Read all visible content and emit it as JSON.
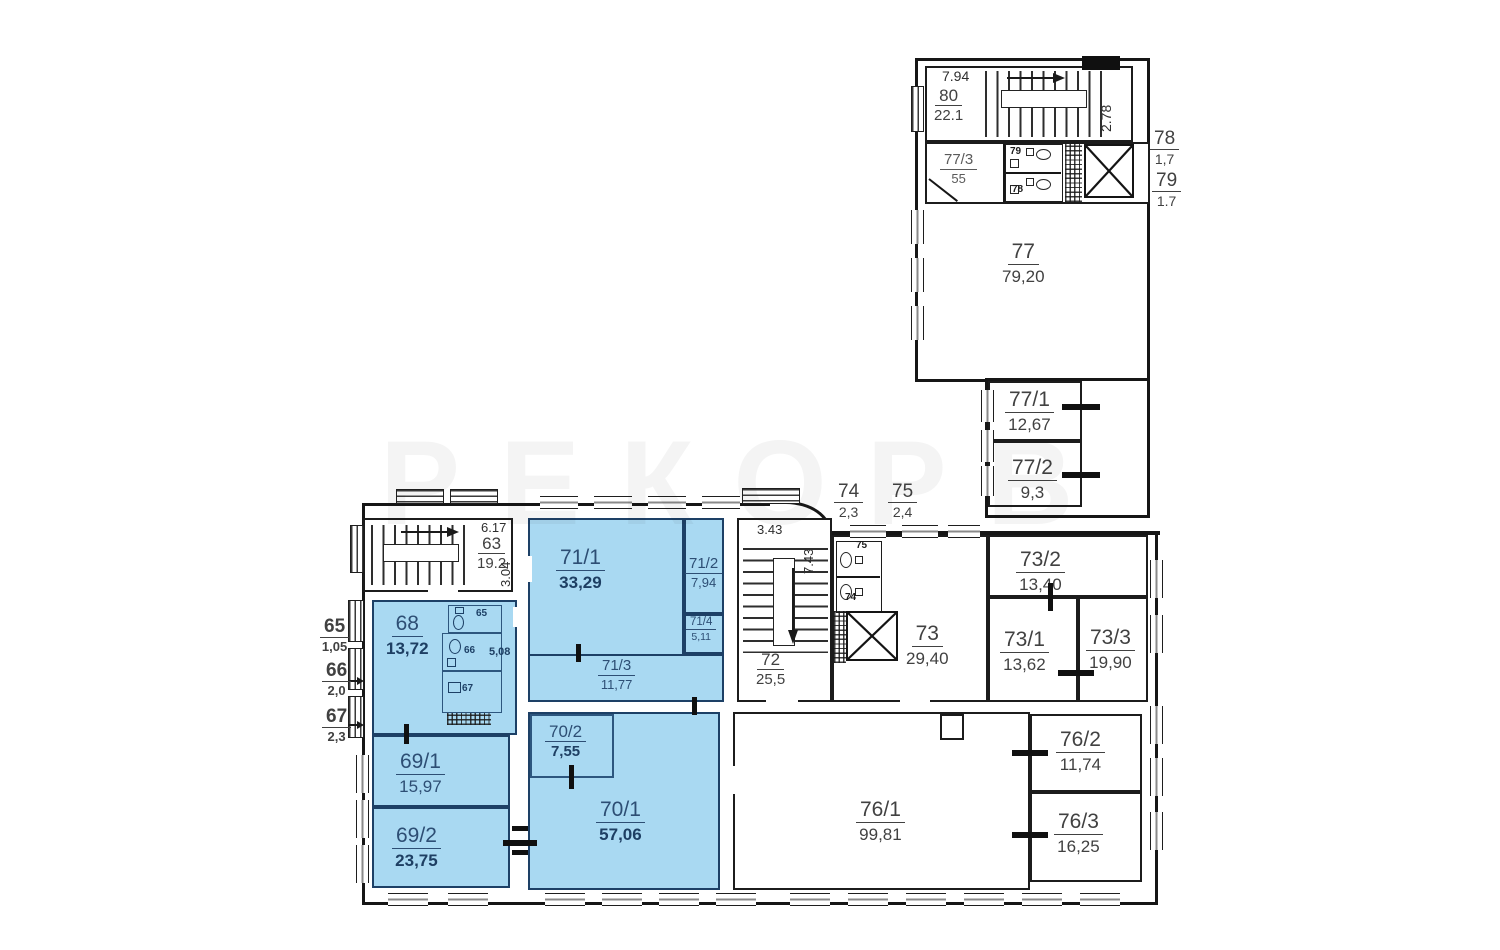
{
  "watermark": "РЕКОРВ",
  "rooms": {
    "r63": {
      "num": "63",
      "area": "19.2"
    },
    "r68": {
      "num": "68",
      "area": "13,72"
    },
    "r69_1": {
      "num": "69/1",
      "area": "15,97"
    },
    "r69_2": {
      "num": "69/2",
      "area": "23,75"
    },
    "r70_1": {
      "num": "70/1",
      "area": "57,06"
    },
    "r70_2": {
      "num": "70/2",
      "area": "7,55"
    },
    "r71_1": {
      "num": "71/1",
      "area": "33,29"
    },
    "r71_2": {
      "num": "71/2",
      "area": "7,94"
    },
    "r71_3": {
      "num": "71/3",
      "area": "11,77"
    },
    "r71_4": {
      "num": "71/4",
      "area": "5,11"
    },
    "r72": {
      "num": "72",
      "area": "25,5"
    },
    "r73": {
      "num": "73",
      "area": "29,40"
    },
    "r73_1": {
      "num": "73/1",
      "area": "13,62"
    },
    "r73_2": {
      "num": "73/2",
      "area": "13,40"
    },
    "r73_3": {
      "num": "73/3",
      "area": "19,90"
    },
    "r76_1": {
      "num": "76/1",
      "area": "99,81"
    },
    "r76_2": {
      "num": "76/2",
      "area": "11,74"
    },
    "r76_3": {
      "num": "76/3",
      "area": "16,25"
    },
    "r77": {
      "num": "77",
      "area": "79,20"
    },
    "r77_1": {
      "num": "77/1",
      "area": "12,67"
    },
    "r77_2": {
      "num": "77/2",
      "area": "9,3"
    },
    "r77_3": {
      "num": "77/3",
      "area": "55"
    },
    "r80": {
      "num": "80",
      "area": "22.1"
    }
  },
  "outside_labels": {
    "o65": {
      "num": "65",
      "area": "1,05"
    },
    "o66": {
      "num": "66",
      "area": "2,0"
    },
    "o67": {
      "num": "67",
      "area": "2,3"
    },
    "o74": {
      "num": "74",
      "area": "2,3"
    },
    "o75": {
      "num": "75",
      "area": "2,4"
    },
    "o78": {
      "num": "78",
      "area": "1,7"
    },
    "o79": {
      "num": "79",
      "area": "1.7"
    }
  },
  "dimensions": {
    "top_stair_width": "7.94",
    "top_stair_depth": "2.78",
    "left_stair_width": "6.17",
    "left_stair_depth": "3.04",
    "center_stair_width": "3.43",
    "center_stair_depth": "7.43",
    "room68_recess": "5,08"
  },
  "wc_labels": {
    "w65": "65",
    "w66": "66",
    "w67": "67",
    "w74": "74",
    "w75": "75",
    "w78": "78",
    "w79": "79"
  }
}
